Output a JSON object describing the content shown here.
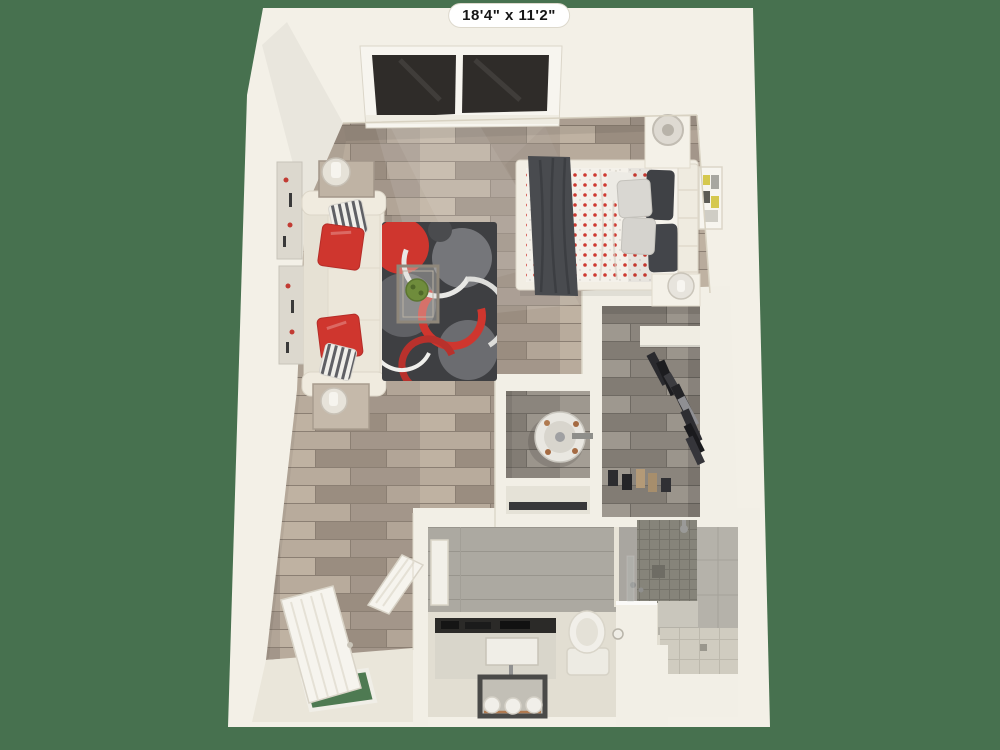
{
  "floorplan": {
    "dimension_label": "18'4\" x 11'2\""
  },
  "colors": {
    "background": "#47714F",
    "wall": "#F3F0E7",
    "wall_shade": "#E9E5D8",
    "wood_floor": "#AFA294",
    "gray_floor": "#97918A",
    "bath_floor": "#E2DED2",
    "bath_wall_tile": "#ACA9A1",
    "shower_tile": "#86847A",
    "rug_base": "#3E3F42",
    "rug_gray": "#6B6C70",
    "rug_white": "#E8E8E5",
    "accent_red": "#CF362E",
    "comforter_dot": "#CE3A31",
    "sofa": "#EDE8DC",
    "pillow_gray": "#D9D7D2",
    "pillow_dark": "#3F4145",
    "blanket_dark": "#494B4F",
    "mat_green": "#4E7A52",
    "window_glass": "#2F2C29",
    "counter_dark": "#2B2A28",
    "plant_green": "#6F8C3C",
    "copper": "#B07A50"
  }
}
